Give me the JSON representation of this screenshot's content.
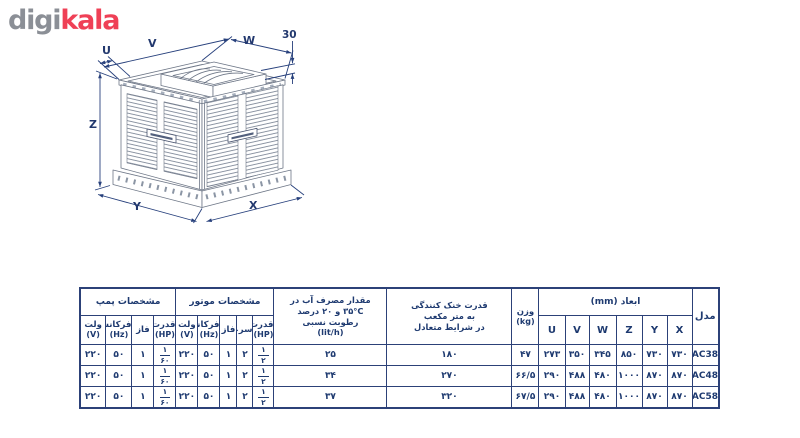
{
  "logo": {
    "digi": "digi",
    "kala": "kala"
  },
  "colors": {
    "logo_gray": "#8b8f96",
    "logo_red": "#ef4056",
    "table_navy": "#1e3a70",
    "drawing_line_gray": "#6e7787",
    "dimension_navy": "#27407c"
  },
  "diagram": {
    "dim_labels": {
      "u": "U",
      "v": "V",
      "w": "W",
      "z": "Z",
      "y": "Y",
      "x": "X",
      "collar_height": "30"
    }
  },
  "table": {
    "pump": {
      "title": "مشخصات پمپ",
      "cols": [
        {
          "label": "ولت",
          "unit": "(V)"
        },
        {
          "label": "فرکانس",
          "unit": "(Hz)"
        },
        {
          "label": "فاز",
          "unit": ""
        },
        {
          "label": "قدرت",
          "unit": "(HP)"
        }
      ]
    },
    "motor": {
      "title": "مشخصات موتور",
      "cols": [
        {
          "label": "ولت",
          "unit": "(V)"
        },
        {
          "label": "فرکانس",
          "unit": "(Hz)"
        },
        {
          "label": "فاز",
          "unit": ""
        },
        {
          "label": "سرعت",
          "unit": ""
        },
        {
          "label": "قدرت",
          "unit": "(HP)"
        }
      ]
    },
    "water": {
      "l1": "مقدار مصرف آب در",
      "l2": "۳۵°C و ۲۰ درصد",
      "l3": "رطوبت نسبی",
      "l4": "(lit/h)"
    },
    "cooling": {
      "l1": "قدرت خنک کنندگی",
      "l2": "به متر مکعب",
      "l3": "در شرایط متعادل"
    },
    "weight": {
      "l1": "وزن",
      "l2": "(kg)"
    },
    "dims": {
      "title": "ابعاد (mm)",
      "cols": [
        "U",
        "V",
        "W",
        "Z",
        "Y",
        "X"
      ]
    },
    "model_header": "مدل",
    "rows": [
      {
        "p_volt": "۲۲۰",
        "p_freq": "۵۰",
        "p_phase": "۱",
        "p_hp_n": "۱",
        "p_hp_d": "۶۰",
        "m_volt": "۲۲۰",
        "m_freq": "۵۰",
        "m_phase": "۱",
        "m_speed": "۲",
        "m_hp_n": "۱",
        "m_hp_d": "۲",
        "water": "۲۵",
        "cooling": "۱۸۰",
        "weight": "۴۷",
        "u": "۲۷۳",
        "v": "۳۵۰",
        "w": "۳۴۵",
        "z": "۸۵۰",
        "y": "۷۳۰",
        "x": "۷۳۰",
        "model": "AC38"
      },
      {
        "p_volt": "۲۲۰",
        "p_freq": "۵۰",
        "p_phase": "۱",
        "p_hp_n": "۱",
        "p_hp_d": "۶۰",
        "m_volt": "۲۲۰",
        "m_freq": "۵۰",
        "m_phase": "۱",
        "m_speed": "۲",
        "m_hp_n": "۱",
        "m_hp_d": "۲",
        "water": "۳۴",
        "cooling": "۲۷۰",
        "weight": "۶۶/۵",
        "u": "۲۹۰",
        "v": "۴۸۸",
        "w": "۴۸۰",
        "z": "۱۰۰۰",
        "y": "۸۷۰",
        "x": "۸۷۰",
        "model": "AC48"
      },
      {
        "p_volt": "۲۲۰",
        "p_freq": "۵۰",
        "p_phase": "۱",
        "p_hp_n": "۱",
        "p_hp_d": "۶۰",
        "m_volt": "۲۲۰",
        "m_freq": "۵۰",
        "m_phase": "۱",
        "m_speed": "۲",
        "m_hp_n": "۱",
        "m_hp_d": "۲",
        "water": "۳۷",
        "cooling": "۳۲۰",
        "weight": "۶۷/۵",
        "u": "۲۹۰",
        "v": "۴۸۸",
        "w": "۴۸۰",
        "z": "۱۰۰۰",
        "y": "۸۷۰",
        "x": "۸۷۰",
        "model": "AC58"
      }
    ]
  }
}
